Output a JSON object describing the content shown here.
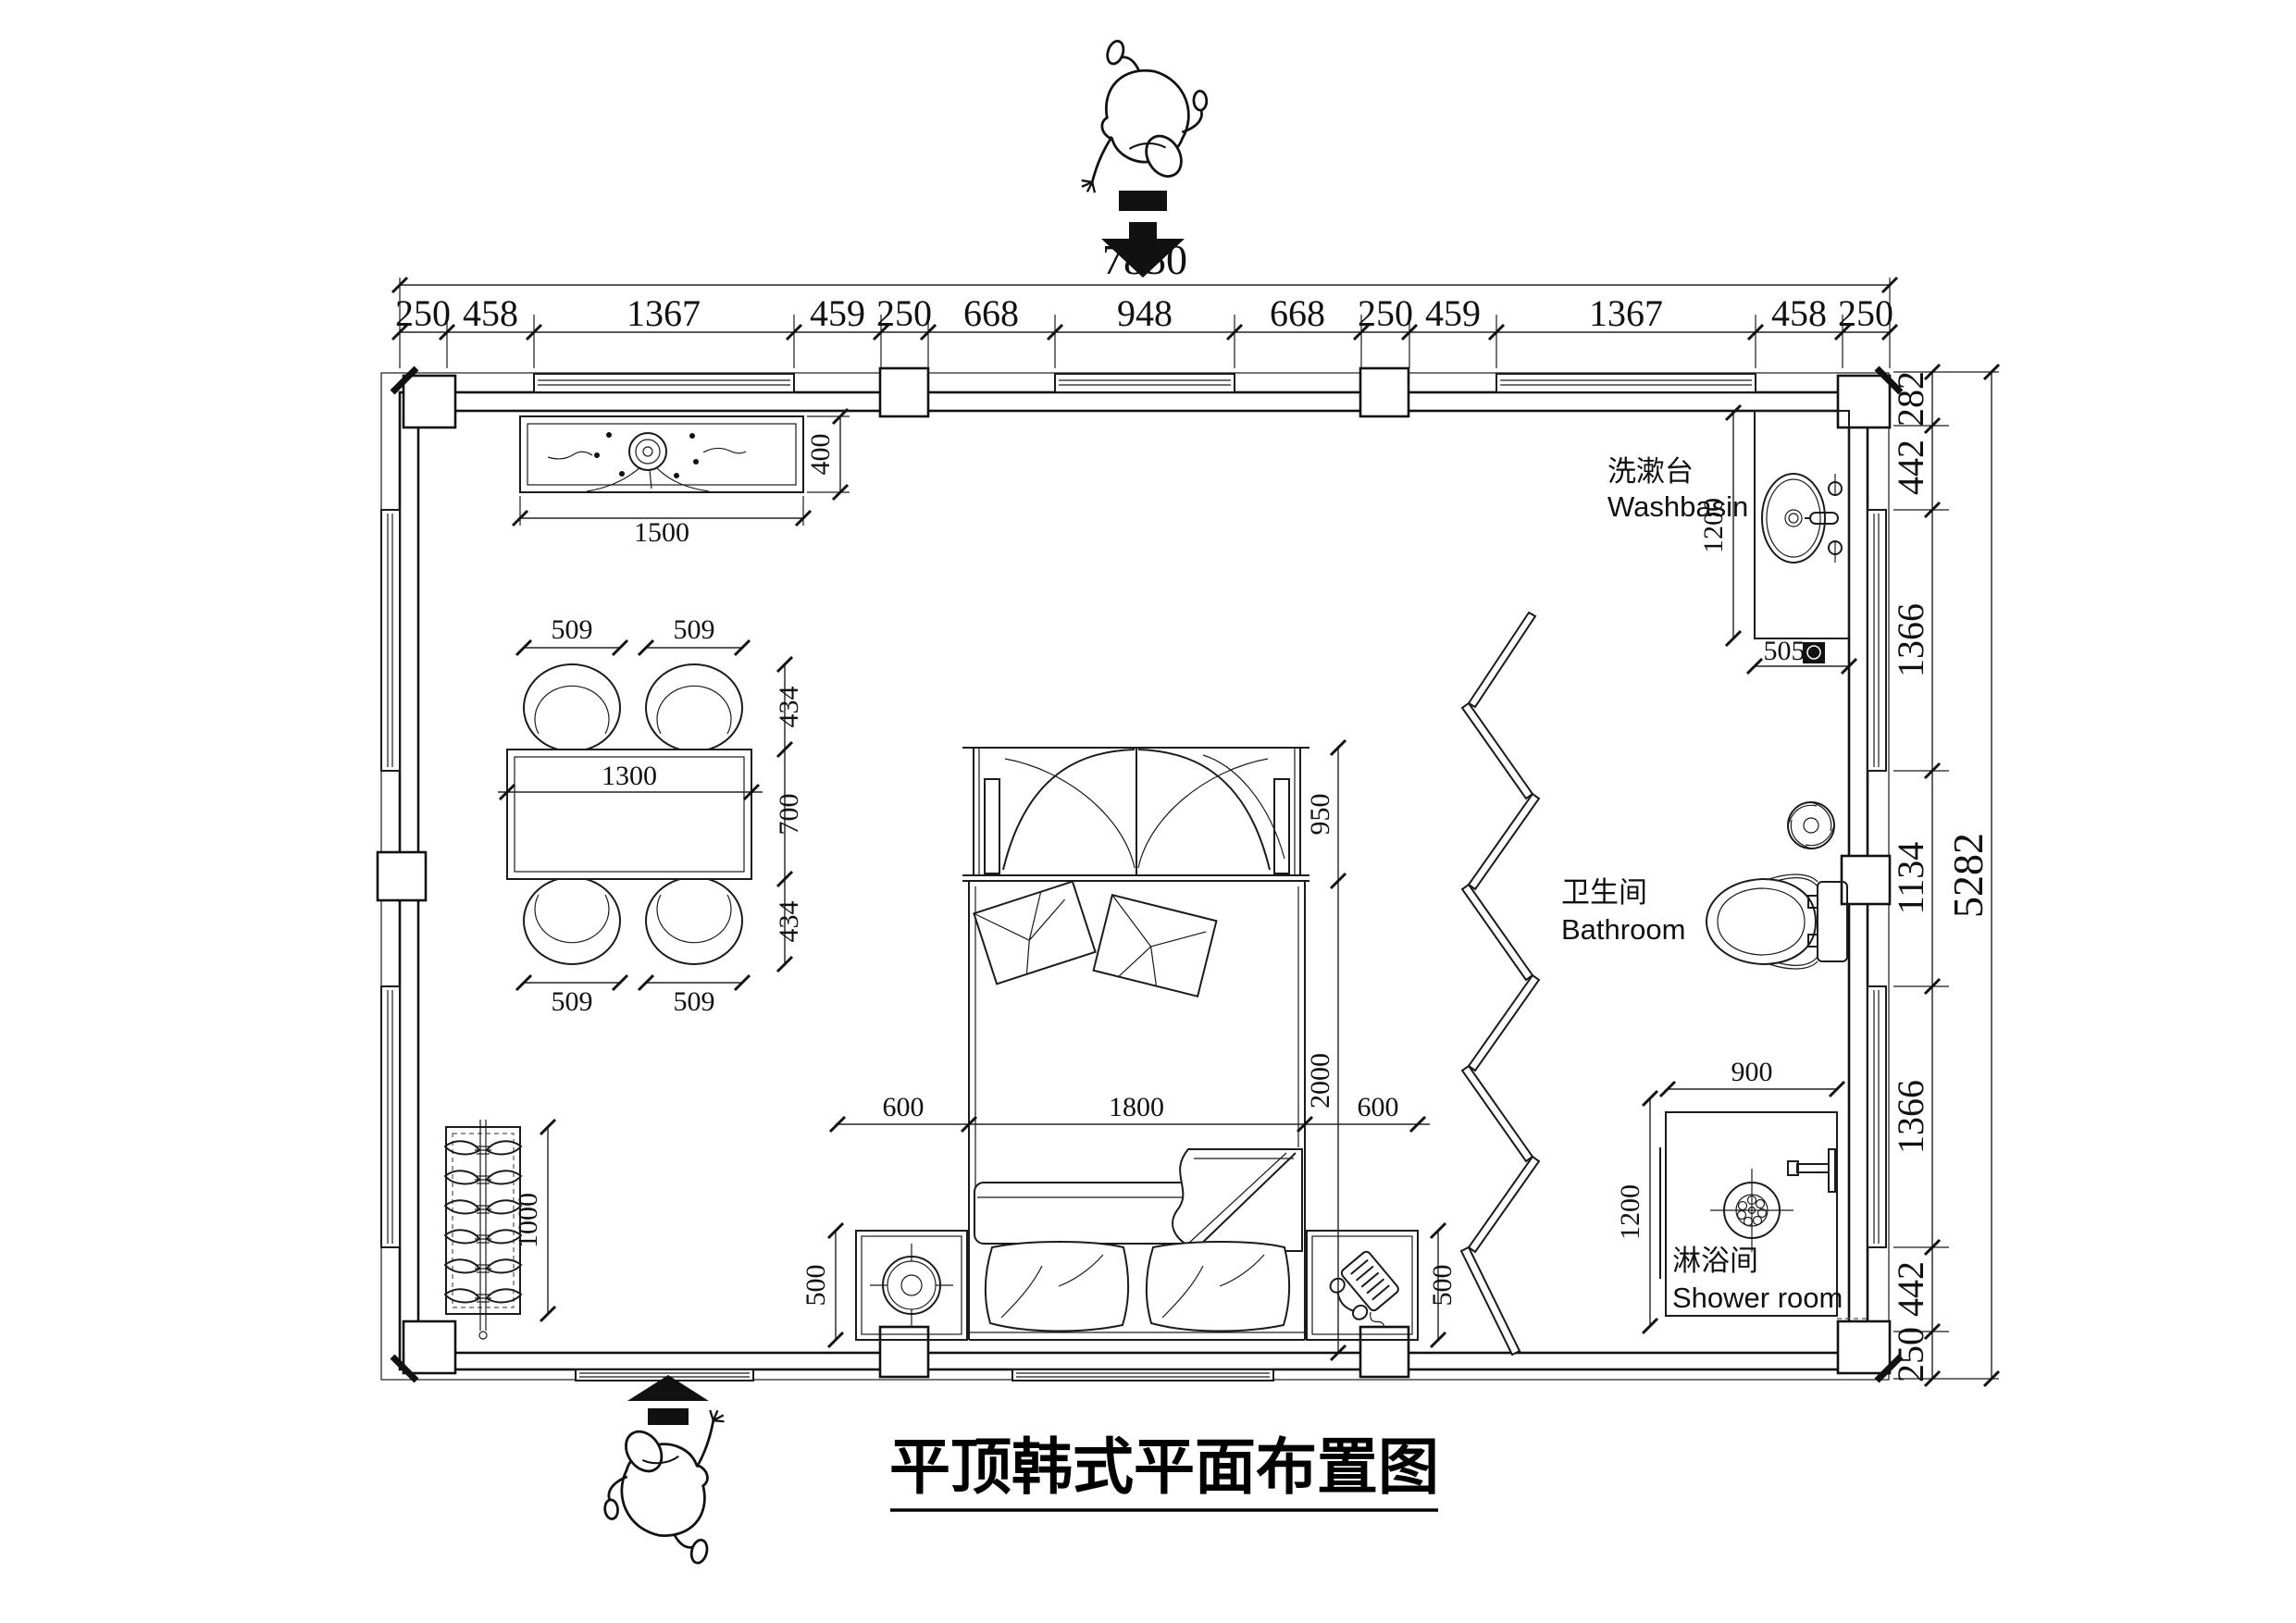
{
  "title": "平顶韩式平面布置图",
  "dims": {
    "top_total": "7850",
    "top_segments": [
      "250",
      "458",
      "1367",
      "459",
      "250",
      "668",
      "948",
      "668",
      "250",
      "459",
      "1367",
      "458",
      "250"
    ],
    "right_total": "5282",
    "right_segments": [
      "282",
      "442",
      "1366",
      "1134",
      "1366",
      "442",
      "250"
    ],
    "cabinet": {
      "width": "1500",
      "depth": "400"
    },
    "dining": {
      "chair_w": "509",
      "chair_d": "434",
      "table_w": "1300",
      "table_d": "700"
    },
    "bed": {
      "canopy": "950",
      "width": "1800",
      "length": "2000"
    },
    "nightstand": {
      "width": "600",
      "depth": "500"
    },
    "wardrobe": {
      "height": "1000"
    },
    "washbasin": {
      "length": "1200",
      "width": "505"
    },
    "shower": {
      "width": "900",
      "depth": "1200"
    }
  },
  "labels": {
    "washbasin": {
      "zh": "洗漱台",
      "en": "Washbasin"
    },
    "bathroom": {
      "zh": "卫生间",
      "en": "Bathroom"
    },
    "shower": {
      "zh": "淋浴间",
      "en": "Shower room"
    }
  }
}
